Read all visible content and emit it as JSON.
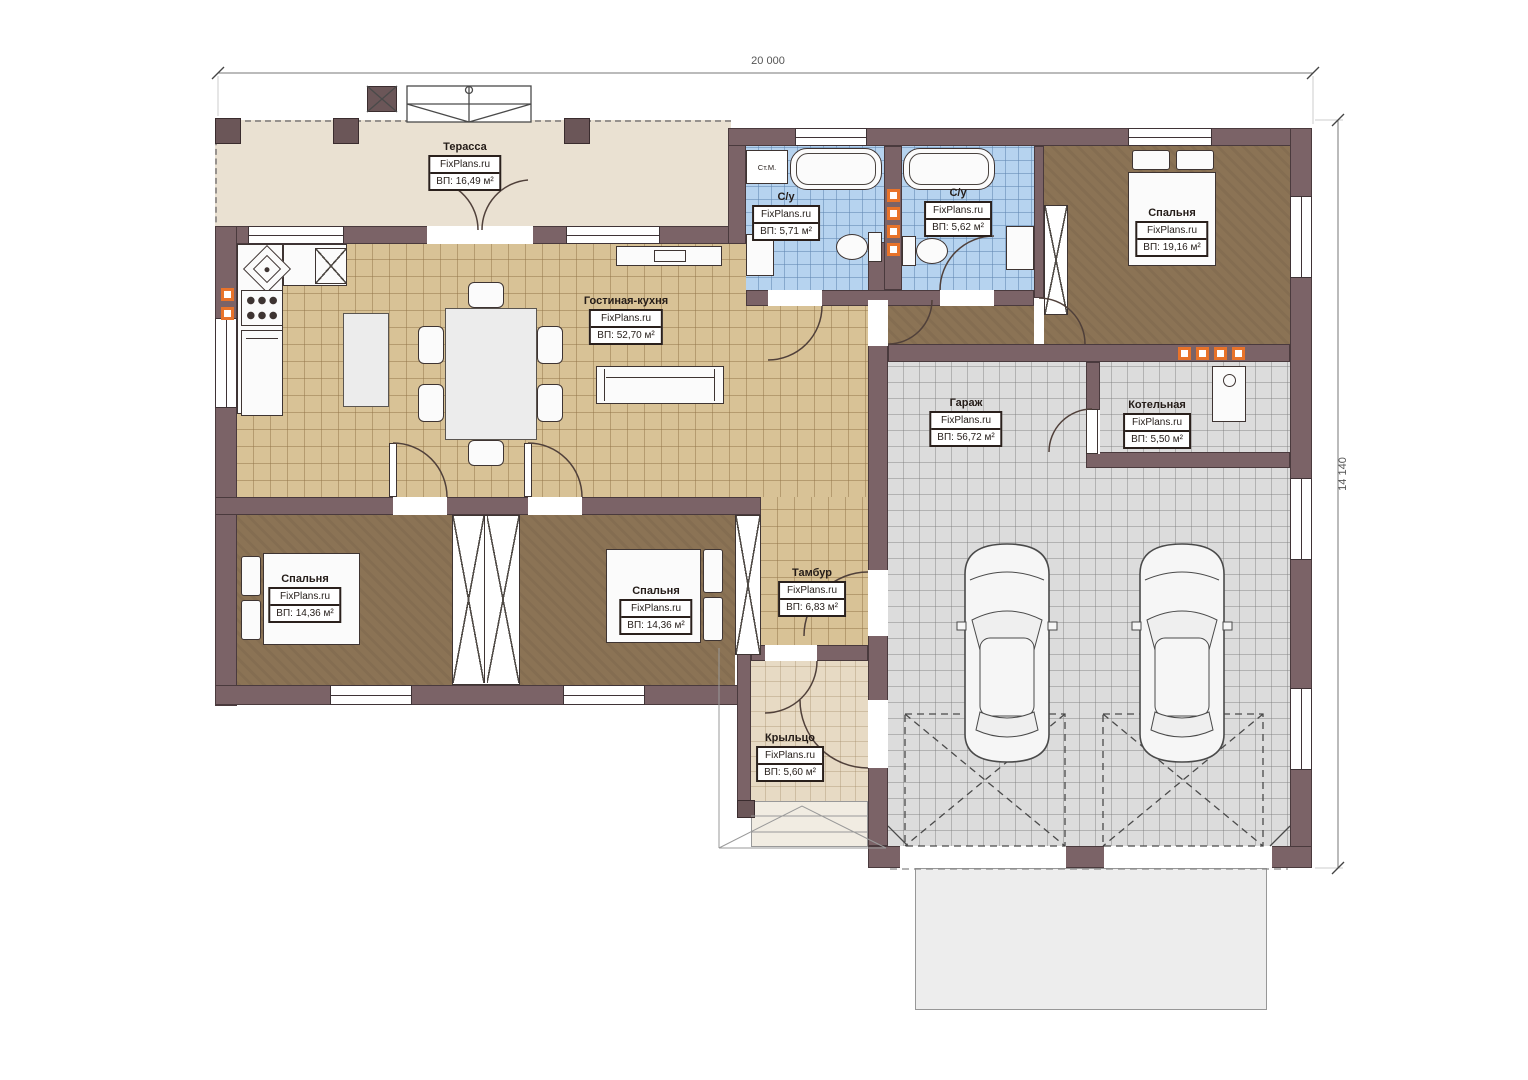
{
  "plan": {
    "watermark": "FixPlans.ru",
    "dimensions": {
      "width_label": "20 000",
      "height_label": "14 140"
    },
    "fixtures": {
      "washing_machine_label": "Ст.М."
    },
    "rooms": [
      {
        "id": "terrace",
        "name": "Терасса",
        "area": "ВП: 16,49 м²"
      },
      {
        "id": "living_kitchen",
        "name": "Гостиная-кухня",
        "area": "ВП: 52,70 м²"
      },
      {
        "id": "bathroom_1",
        "name": "С/у",
        "area": "ВП: 5,71 м²"
      },
      {
        "id": "bathroom_2",
        "name": "С/у",
        "area": "ВП: 5,62 м²"
      },
      {
        "id": "bedroom_main",
        "name": "Спальня",
        "area": "ВП: 19,16 м²"
      },
      {
        "id": "garage",
        "name": "Гараж",
        "area": "ВП: 56,72 м²"
      },
      {
        "id": "boiler_room",
        "name": "Котельная",
        "area": "ВП: 5,50 м²"
      },
      {
        "id": "bedroom_a",
        "name": "Спальня",
        "area": "ВП: 14,36 м²"
      },
      {
        "id": "bedroom_b",
        "name": "Спальня",
        "area": "ВП: 14,36 м²"
      },
      {
        "id": "vestibule",
        "name": "Тамбур",
        "area": "ВП: 6,83 м²"
      },
      {
        "id": "porch",
        "name": "Крыльцо",
        "area": "ВП: 5,60 м²"
      }
    ],
    "colors": {
      "wall": "#7b6367",
      "floor_tan": "#d8c296",
      "floor_blue": "#b6d3ef",
      "floor_gray": "#dcdcdc",
      "floor_brown": "#8b7355",
      "terrace": "#eae1d2",
      "porch": "#e7dac4",
      "vent_orange": "#e8732a"
    }
  }
}
